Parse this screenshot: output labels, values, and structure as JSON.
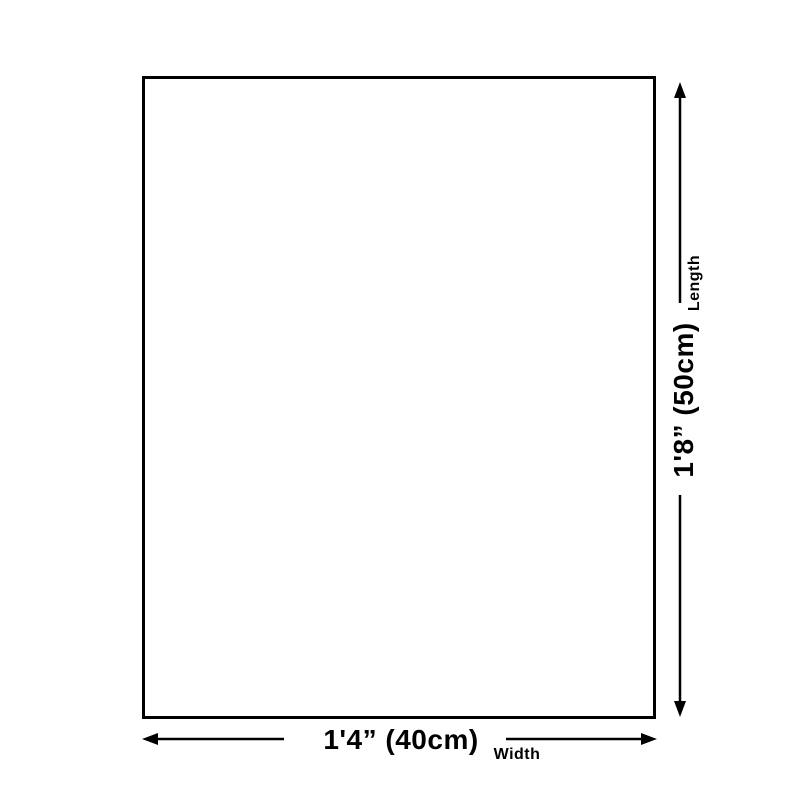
{
  "diagram": {
    "length": {
      "label": "Length",
      "value": "1'8” (50cm)"
    },
    "width": {
      "label": "Width",
      "value": "1'4” (40cm)"
    },
    "colors": {
      "line": "#000000",
      "outline": "#000000",
      "background": "#ffffff"
    }
  }
}
